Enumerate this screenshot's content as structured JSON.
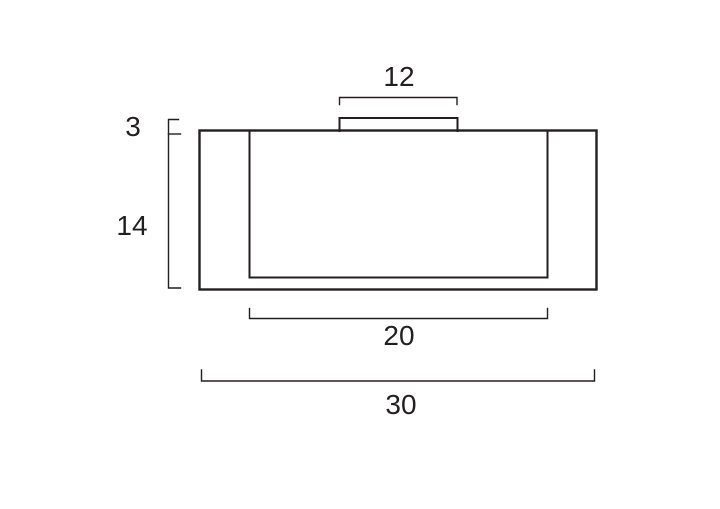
{
  "diagram": {
    "background_color": "#ffffff",
    "line_color": "#231f20",
    "dimensions": {
      "top_width": "12",
      "left_upper_height": "3",
      "left_lower_height": "14",
      "bottom_inner_width": "20",
      "bottom_overall_width": "30"
    }
  }
}
